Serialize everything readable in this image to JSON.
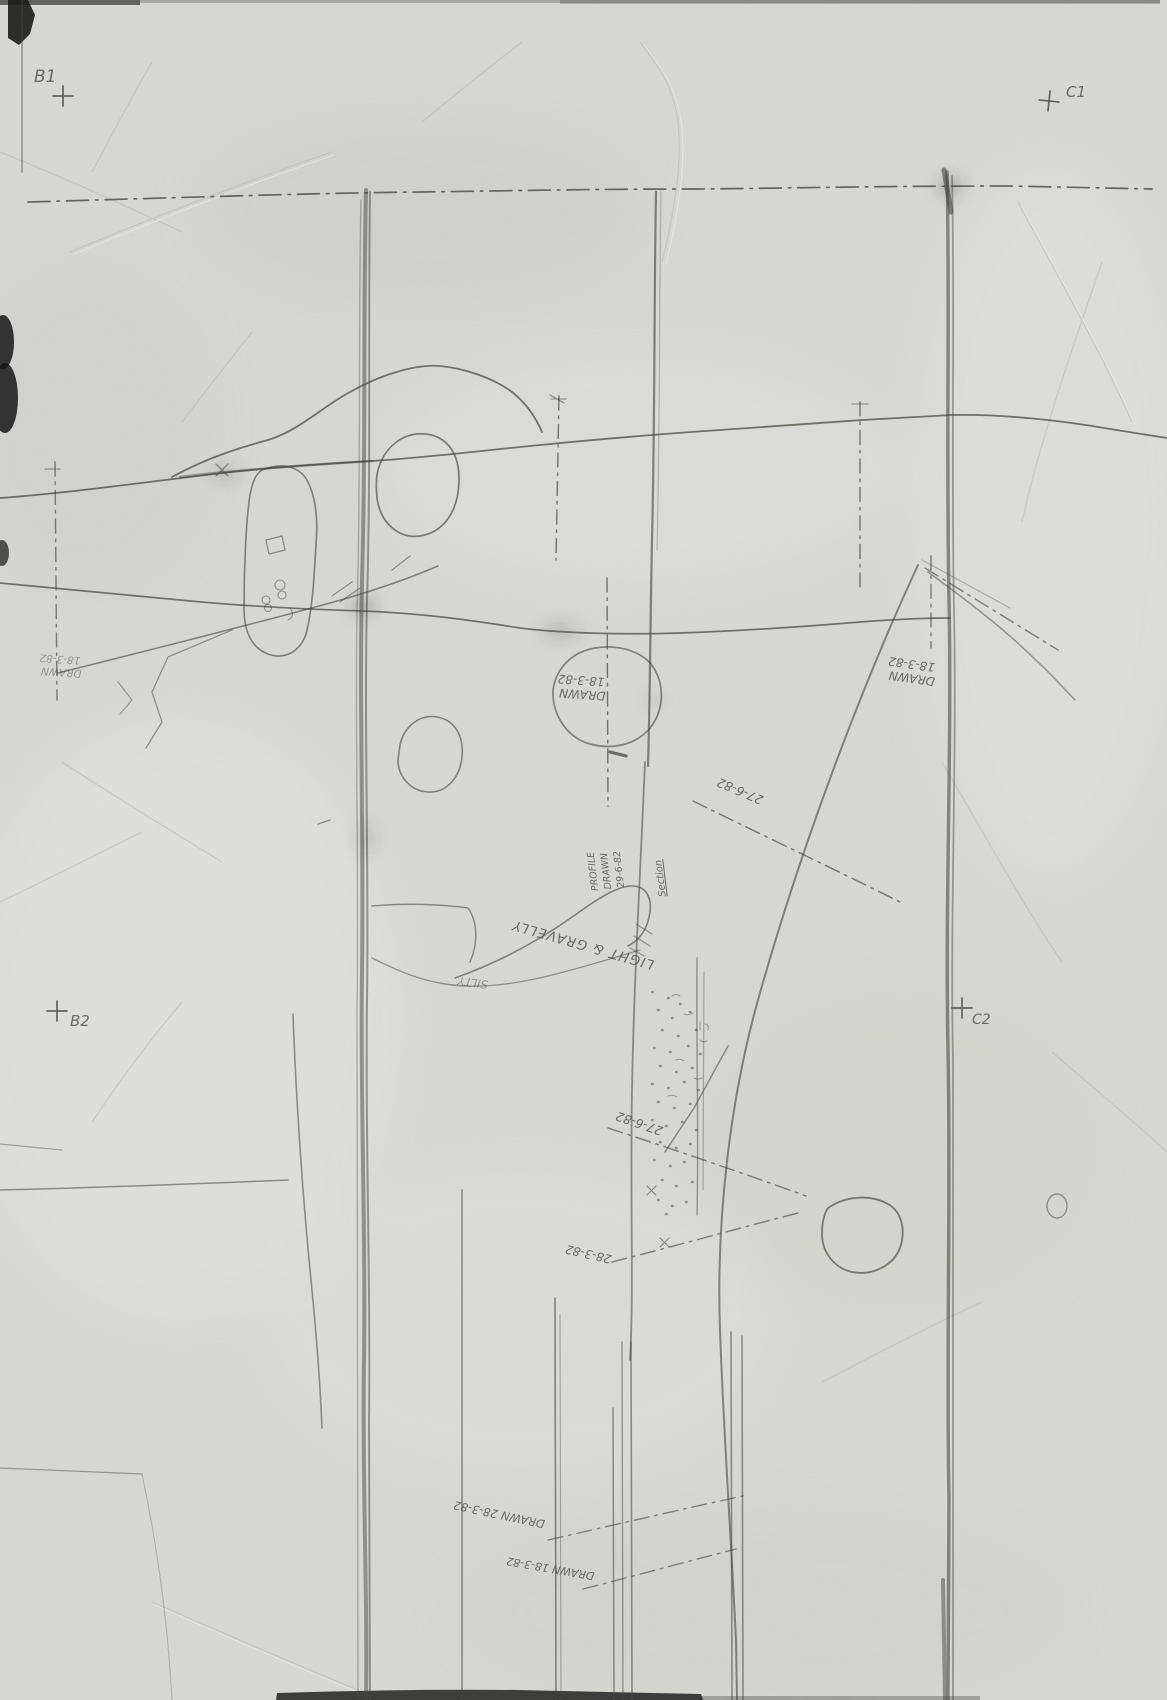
{
  "document_kind": "scanned pencil field drawing",
  "colors": {
    "paper": "#d9d9d6",
    "pencil": "#45453f",
    "scan_edge": "#171717"
  },
  "grid_marks": {
    "b1": {
      "label": "B1"
    },
    "c1": {
      "label": "C1"
    },
    "b2": {
      "label": "B2"
    },
    "c2": {
      "label": "C2"
    }
  },
  "annotations": {
    "left_drawn": {
      "line1": "DRAWN",
      "line2": "18-3-82"
    },
    "mid_drawn": {
      "line1": "DRAWN",
      "line2": "18-3-82"
    },
    "right_drawn": {
      "line1": "DRAWN",
      "line2": "18-3-82"
    },
    "profile_note": {
      "line1": "PROFILE",
      "line2": "DRAWN",
      "line3": "29-6-82"
    },
    "section_note": {
      "text": "Section"
    },
    "soil_light_gravelly": {
      "text": "LIGHT & GRAVELLY"
    },
    "soil_silty": {
      "text": "SILTY"
    },
    "survey_27_6_82_upper": {
      "text": "27-6-82"
    },
    "survey_27_6_82_lower": {
      "text": "27-6-82"
    },
    "survey_28_3_82": {
      "text": "28-3-82"
    },
    "drawn_28_3_82_bottom": {
      "text": "DRAWN 28-3-82"
    },
    "drawn_18_3_82_bottom": {
      "text": "DRAWN 18-3-82"
    }
  }
}
